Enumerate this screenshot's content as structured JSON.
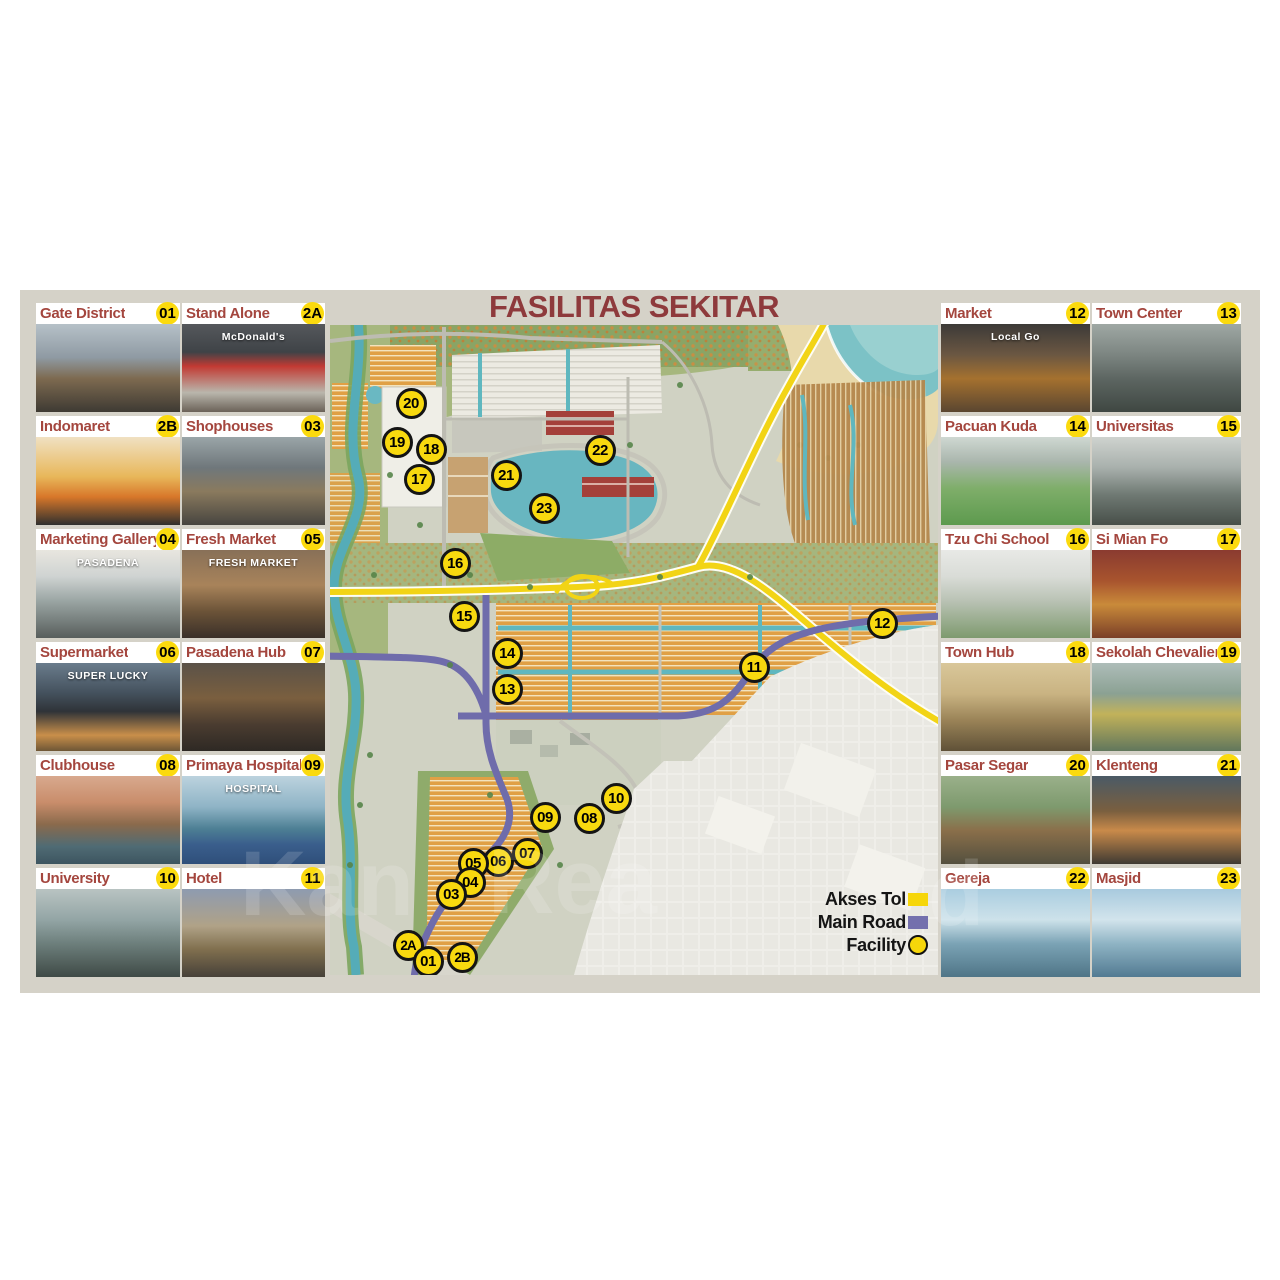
{
  "title": "FASILITAS SEKITAR",
  "watermark": {
    "fragments": [
      {
        "text": "Kan",
        "x": 240,
        "y": 838
      },
      {
        "text": "Rea",
        "x": 488,
        "y": 836
      },
      {
        "text": "d",
        "x": 928,
        "y": 848
      }
    ]
  },
  "left_panel": {
    "cards": [
      {
        "label": "Gate District",
        "badge": "01"
      },
      {
        "label": "Stand Alone",
        "badge": "2A",
        "photo_text": "McDonald's"
      },
      {
        "label": "Indomaret",
        "badge": "2B"
      },
      {
        "label": "Shophouses",
        "badge": "03"
      },
      {
        "label": "Marketing Gallery",
        "badge": "04",
        "photo_text": "PASADENA"
      },
      {
        "label": "Fresh Market",
        "badge": "05",
        "photo_text": "FRESH MARKET"
      },
      {
        "label": "Supermarket",
        "badge": "06",
        "photo_text": "SUPER LUCKY"
      },
      {
        "label": "Pasadena Hub",
        "badge": "07"
      },
      {
        "label": "Clubhouse",
        "badge": "08"
      },
      {
        "label": "Primaya Hospital",
        "badge": "09",
        "photo_text": "HOSPITAL"
      },
      {
        "label": "University",
        "badge": "10"
      },
      {
        "label": "Hotel",
        "badge": "11"
      }
    ]
  },
  "right_panel": {
    "cards": [
      {
        "label": "Market",
        "badge": "12",
        "photo_text": "Local Go"
      },
      {
        "label": "Town Center",
        "badge": "13"
      },
      {
        "label": "Pacuan Kuda",
        "badge": "14"
      },
      {
        "label": "Universitas",
        "badge": "15"
      },
      {
        "label": "Tzu Chi School",
        "badge": "16"
      },
      {
        "label": "Si Mian Fo",
        "badge": "17"
      },
      {
        "label": "Town Hub",
        "badge": "18"
      },
      {
        "label": "Sekolah Chevalier",
        "badge": "19"
      },
      {
        "label": "Pasar Segar",
        "badge": "20"
      },
      {
        "label": "Klenteng",
        "badge": "21"
      },
      {
        "label": "Gereja",
        "badge": "22"
      },
      {
        "label": "Masjid",
        "badge": "23"
      }
    ]
  },
  "legend": {
    "items": [
      {
        "label": "Akses Tol",
        "swatch": "rect",
        "color": "#f6d60a"
      },
      {
        "label": "Main Road",
        "swatch": "rect",
        "color": "#7470ad"
      },
      {
        "label": "Facility",
        "swatch": "circle",
        "color": "#f6d60a"
      }
    ]
  },
  "map_markers": [
    {
      "id": "20",
      "x": 81,
      "y": 78
    },
    {
      "id": "19",
      "x": 67,
      "y": 117
    },
    {
      "id": "18",
      "x": 101,
      "y": 124
    },
    {
      "id": "17",
      "x": 89,
      "y": 154
    },
    {
      "id": "21",
      "x": 176,
      "y": 150
    },
    {
      "id": "22",
      "x": 270,
      "y": 125
    },
    {
      "id": "23",
      "x": 214,
      "y": 183
    },
    {
      "id": "16",
      "x": 125,
      "y": 238
    },
    {
      "id": "15",
      "x": 134,
      "y": 291
    },
    {
      "id": "14",
      "x": 177,
      "y": 328
    },
    {
      "id": "13",
      "x": 177,
      "y": 364
    },
    {
      "id": "12",
      "x": 552,
      "y": 298
    },
    {
      "id": "11",
      "x": 424,
      "y": 342
    },
    {
      "id": "10",
      "x": 286,
      "y": 473
    },
    {
      "id": "09",
      "x": 215,
      "y": 492
    },
    {
      "id": "08",
      "x": 259,
      "y": 493
    },
    {
      "id": "07",
      "x": 197,
      "y": 528
    },
    {
      "id": "06",
      "x": 168,
      "y": 536
    },
    {
      "id": "05",
      "x": 143,
      "y": 538
    },
    {
      "id": "04",
      "x": 140,
      "y": 557
    },
    {
      "id": "03",
      "x": 121,
      "y": 569
    },
    {
      "id": "2A",
      "x": 78,
      "y": 620
    },
    {
      "id": "01",
      "x": 98,
      "y": 636
    },
    {
      "id": "2B",
      "x": 132,
      "y": 632
    }
  ],
  "colors": {
    "accent_red": "#9c3f3b",
    "badge_yellow": "#f8d90f",
    "panel_bg": "#d5d2c8",
    "toll_yellow": "#f2d415",
    "main_road_purple": "#6f6cab"
  }
}
